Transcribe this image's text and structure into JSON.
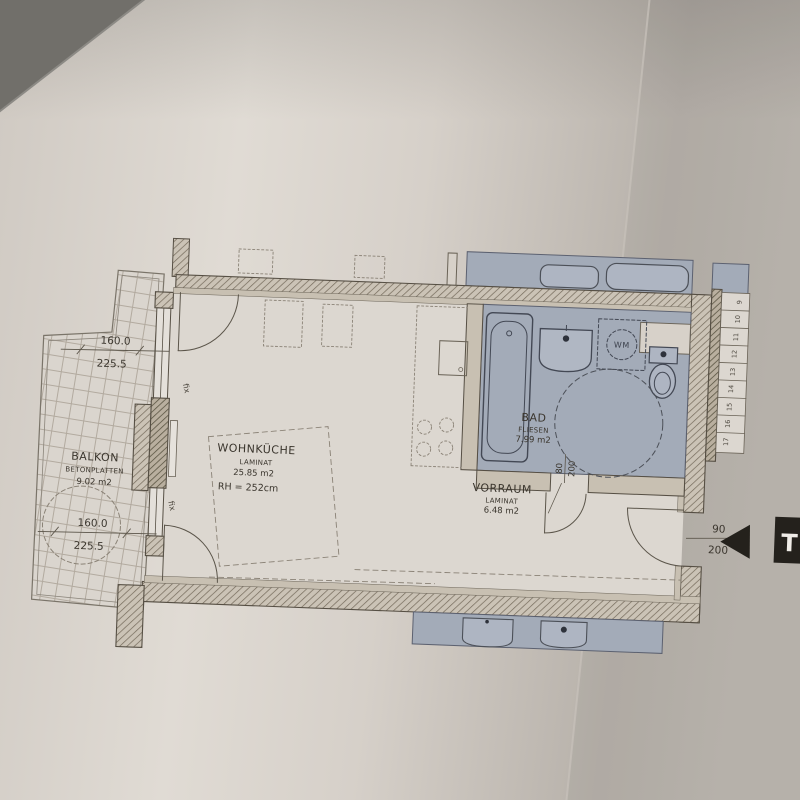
{
  "rooms": {
    "balkon": {
      "name": "BALKON",
      "material": "BETONPLATTEN",
      "area": "9.02 m2"
    },
    "wohnkueche": {
      "name": "WOHNKÜCHE",
      "material": "LAMINAT",
      "area": "25.85 m2",
      "ceiling": "RH = 252cm"
    },
    "bad": {
      "name": "BAD",
      "material": "FLIESEN",
      "area": "7.99 m2"
    },
    "vorraum": {
      "name": "VORRAUM",
      "material": "LAMINAT",
      "area": "6.48 m2"
    }
  },
  "dims": {
    "balcony_top": {
      "a": "160.0",
      "b": "225.5"
    },
    "balcony_bottom": {
      "a": "160.0",
      "b": "225.5"
    },
    "bad_door": {
      "w": "80",
      "h": "200"
    },
    "entrance_door": {
      "w": "90",
      "h": "200"
    }
  },
  "labels": {
    "washing_machine": "WM",
    "window_fixed_top": "fix",
    "window_fixed_bottom": "fix",
    "entrance_marker": "T"
  },
  "stairs": {
    "steps": [
      "9",
      "10",
      "11",
      "12",
      "13",
      "14",
      "15",
      "16",
      "17"
    ]
  },
  "colors": {
    "paper": "#d8d2cb",
    "background": "#6e6c68",
    "wall_line": "#564f44",
    "bathroom_fill": "#a3abb8",
    "marker_black": "#24211c"
  }
}
